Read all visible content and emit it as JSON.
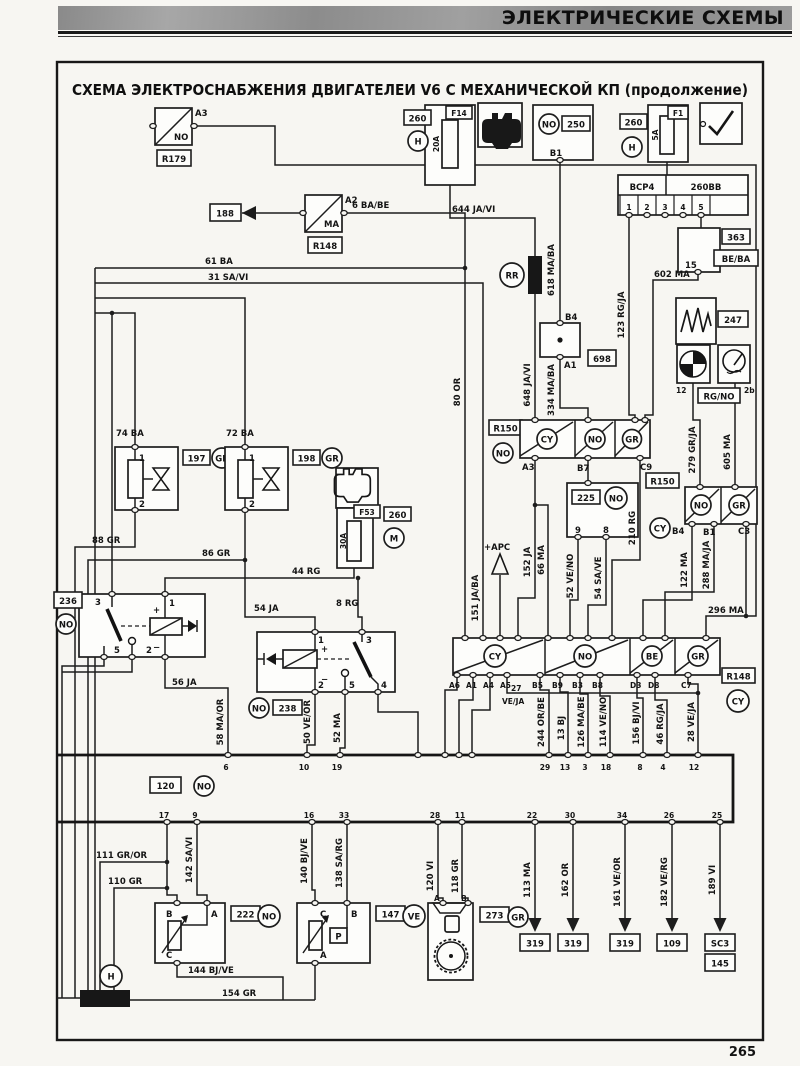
{
  "page": {
    "header": "ЭЛЕКТРИЧЕСКИЕ СХЕМЫ",
    "page_number": "265"
  },
  "title": "СХЕМА ЭЛЕКТРОСНАБЖЕНИЯ ДВИГАТЕЛЕИ V6 С МЕХАНИЧЕСКОЙ КП (продолжение)",
  "boxes": {
    "r179": "R179",
    "n188": "188",
    "r148": "R148",
    "n260": "260",
    "f14": "F14",
    "n250": "250",
    "f1": "F1",
    "bcp4": "BCP4",
    "n260bb": "260BB",
    "n363": "363",
    "beba": "BE/BA",
    "n247": "247",
    "rgno": "RG/NO",
    "r150": "R150",
    "n698": "698",
    "n225": "225",
    "n197": "197",
    "n198": "198",
    "f53": "F53",
    "n236": "236",
    "n238": "238",
    "n120": "120",
    "n222": "222",
    "n147": "147",
    "n273": "273",
    "n319": "319",
    "n109": "109",
    "sc3": "SC3",
    "n145": "145"
  },
  "circles": {
    "no": "NO",
    "gr": "GR",
    "cy": "CY",
    "be": "BE",
    "h": "H",
    "m": "M",
    "ve": "VE",
    "rr": "RR",
    "ma": "MA",
    "p": "P"
  },
  "fuses": {
    "f14": "20A",
    "f1": "5A",
    "f53": "30A"
  },
  "pins": {
    "a3": "A3",
    "a2": "A2",
    "b1": "B1",
    "b4": "B4",
    "a1": "A1",
    "b7": "B7",
    "c9": "C9",
    "c3": "C3",
    "a6": "A6",
    "a4": "A4",
    "a5": "A5",
    "b5": "B5",
    "b9": "B9",
    "b3": "B3",
    "b8": "B8",
    "d3": "D3",
    "d8": "D8",
    "c7": "C7",
    "n1": "1",
    "n2": "2",
    "n3": "3",
    "n4": "4",
    "n5": "5",
    "n6": "6",
    "n8": "8",
    "n9": "9",
    "n10": "10",
    "n11": "11",
    "n12": "12",
    "n13": "13",
    "n15": "15",
    "n16": "16",
    "n17": "17",
    "n18": "18",
    "n19": "19",
    "n22": "22",
    "n25": "25",
    "n26": "26",
    "n28": "28",
    "n29": "29",
    "n30": "30",
    "n33": "33",
    "n34": "34",
    "n2b": "2b",
    "a": "A",
    "b": "B",
    "c": "C",
    "plus": "+",
    "minus": "−"
  },
  "wires": {
    "w6": "6 BA/BE",
    "w61": "61 BA",
    "w31": "31 SA/VI",
    "w644": "644 JA/VI",
    "w648": "648 JA/VI",
    "w80": "80 OR",
    "w618": "618 MA/BA",
    "w334": "334 MA/BA",
    "w123": "123 RG/JA",
    "w602": "602 MA",
    "w279": "279 GR/JA",
    "w605": "605 MA",
    "w74": "74 BA",
    "w72": "72 BA",
    "w88": "88 GR",
    "w86": "86 GR",
    "w44": "44 RG",
    "w54": "54 JA",
    "w8": "8 RG",
    "w56": "56 JA",
    "w58": "58 MA/OR",
    "w50": "50 VE/OR",
    "w52": "52 MA",
    "w151": "151 JA/BA",
    "w152": "152 JA",
    "w66": "66 MA",
    "w52v": "52 VE/NO",
    "w54s": "54 SA/VE",
    "w210": "210 RG",
    "w122": "122 MA",
    "w288": "288 MA/JA",
    "w296": "296 MA",
    "w27": "27",
    "w27c": "VE/JA",
    "w244": "244 OR/BE",
    "w13": "13 BJ",
    "w126": "126 MA/BE",
    "w114": "114 VE/NO",
    "w156": "156 BJ/VI",
    "w46": "46 RG/JA",
    "w28": "28 VE/JA",
    "w111": "111 GR/OR",
    "w110": "110 GR",
    "w142": "142 SA/VI",
    "w140": "140 BJ/VE",
    "w138": "138 SA/RG",
    "w120": "120 VI",
    "w118": "118 GR",
    "w144": "144 BJ/VE",
    "w154": "154 GR",
    "w113": "113 MA",
    "w162": "162 OR",
    "w161": "161 VE/OR",
    "w182": "182 VE/RG",
    "w189": "189 VI",
    "apc": "+APC"
  }
}
